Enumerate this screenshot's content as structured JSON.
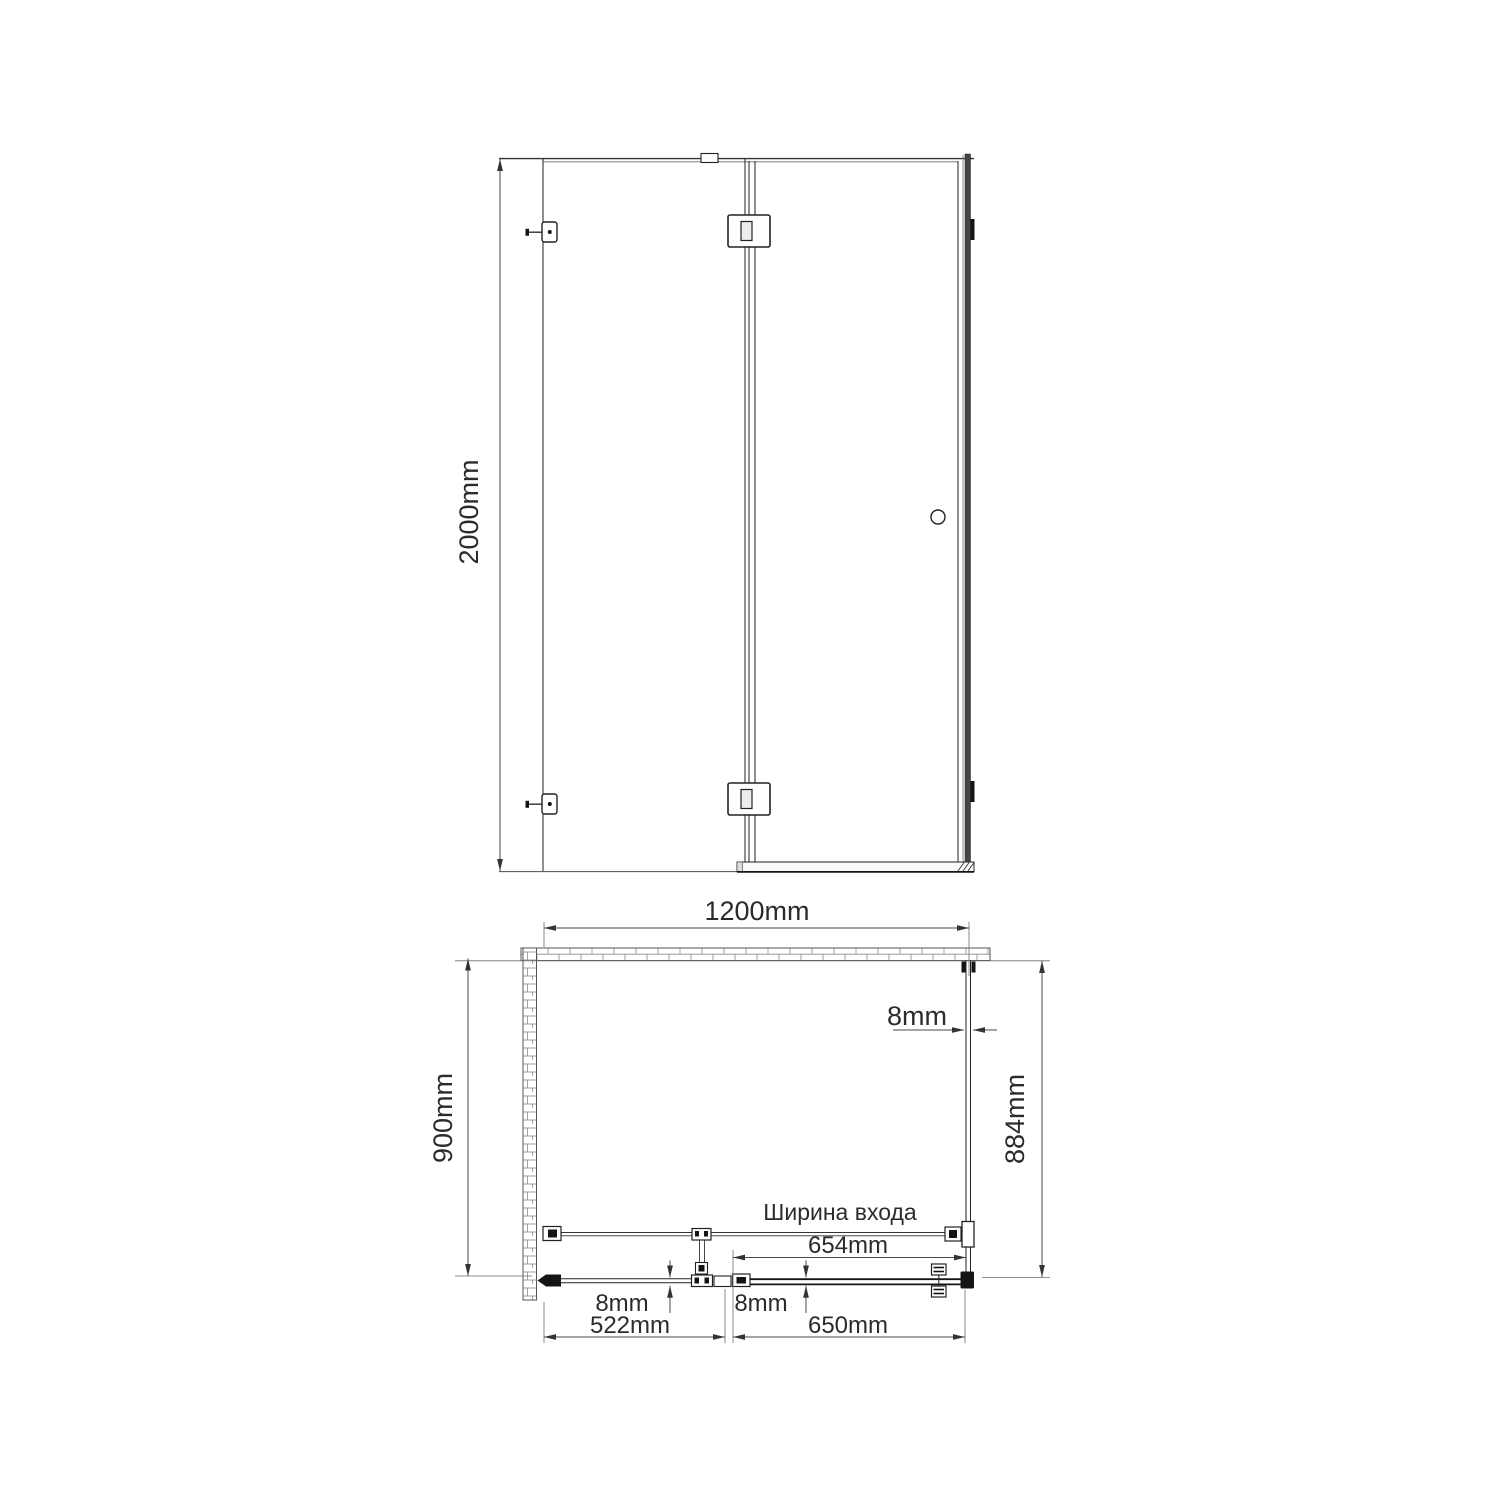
{
  "drawing": {
    "type": "shower-enclosure technical drawing",
    "views": {
      "front": {
        "height": "2000mm"
      },
      "plan": {
        "width": "1200mm",
        "depth": "900mm",
        "side_panel_glass_thickness": "8mm",
        "side_panel_length": "884mm",
        "entrance_caption": "Ширина входа",
        "entrance_width": "654mm",
        "fixed_panel_glass_thickness": "8mm",
        "door_glass_thickness": "8mm",
        "fixed_panel_width": "522mm",
        "door_width": "650mm"
      }
    },
    "colors": {
      "line": "#4a4a4a",
      "dark": "#1a1a1a",
      "text": "#2b2b2b",
      "background": "#ffffff"
    }
  }
}
